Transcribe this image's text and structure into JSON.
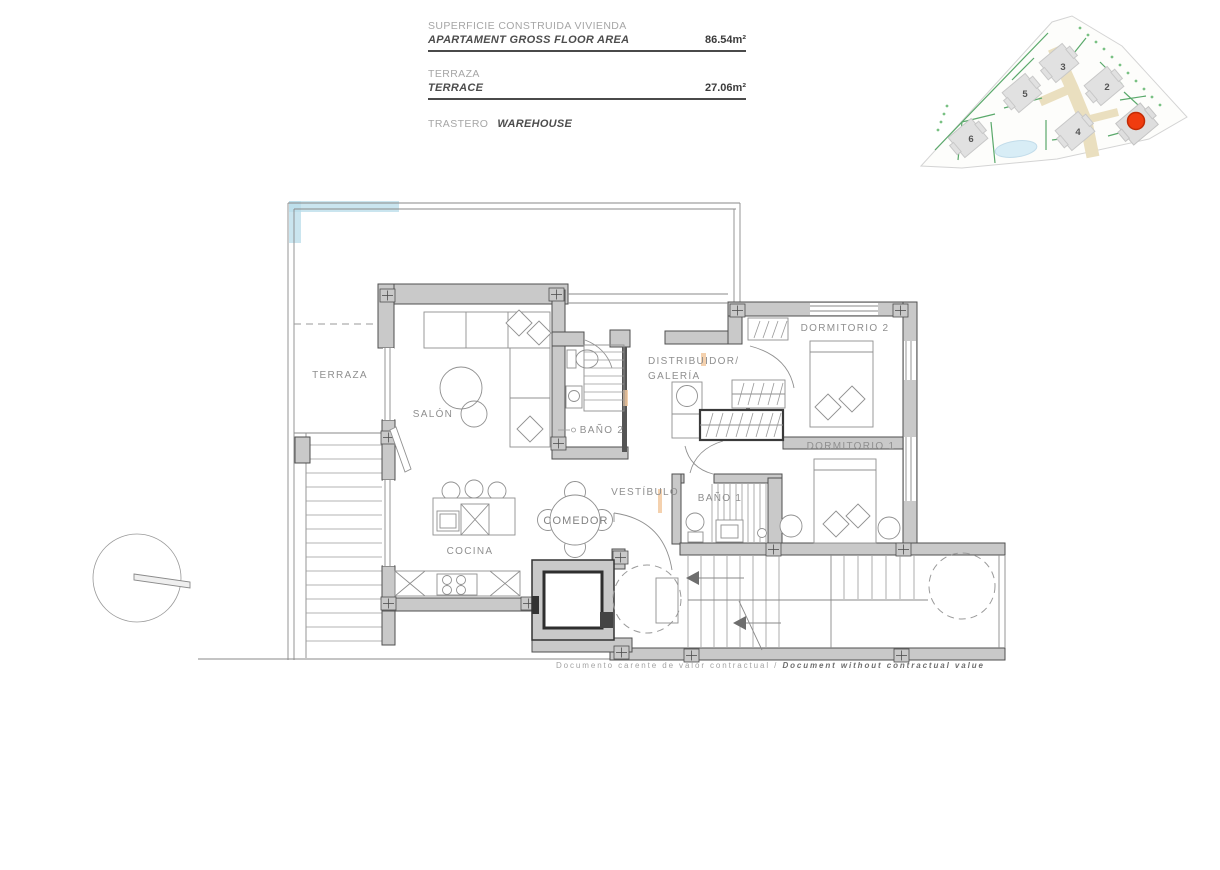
{
  "info_panel": {
    "rows": [
      {
        "label_es": "SUPERFICIE CONSTRUIDA VIVIENDA",
        "label_en": "APARTAMENT GROSS FLOOR AREA",
        "value": "86.54m²"
      },
      {
        "label_es": "TERRAZA",
        "label_en": "TERRACE",
        "value": "27.06m²"
      },
      {
        "label_es": "TRASTERO",
        "label_en": "WAREHOUSE",
        "value": ""
      }
    ]
  },
  "floor_plan": {
    "rooms": {
      "terraza": "TERRAZA",
      "salon": "SALÓN",
      "bano2": "BAÑO 2",
      "distribuidor_line1": "DISTRIBUIDOR/",
      "distribuidor_line2": "GALERÍA",
      "dormitorio2": "DORMITORIO 2",
      "dormitorio1": "DORMITORIO 1",
      "vestibulo": "VESTÍBULO",
      "bano1": "BAÑO 1",
      "cocina": "COCINA",
      "comedor": "COMEDOR"
    }
  },
  "site_plan": {
    "buildings": [
      {
        "num": "3"
      },
      {
        "num": "5"
      },
      {
        "num": "2"
      },
      {
        "num": "6"
      },
      {
        "num": "4"
      }
    ],
    "selected_building": "marked with red dot"
  },
  "disclaimer": {
    "es": "Documento carente de valor contractual / ",
    "en": "Document without contractual value"
  },
  "colors": {
    "wall_fill": "#c9c9c9",
    "wall_stroke": "#4f4f4f",
    "drawing_line": "#8a8a8a",
    "terrace_highlight": "#b8dcea",
    "accent_peach": "#f2c9a0",
    "marker_red": "#f03c0f",
    "site_green": "#5aa96b",
    "site_path_tan": "#eadfbf"
  }
}
